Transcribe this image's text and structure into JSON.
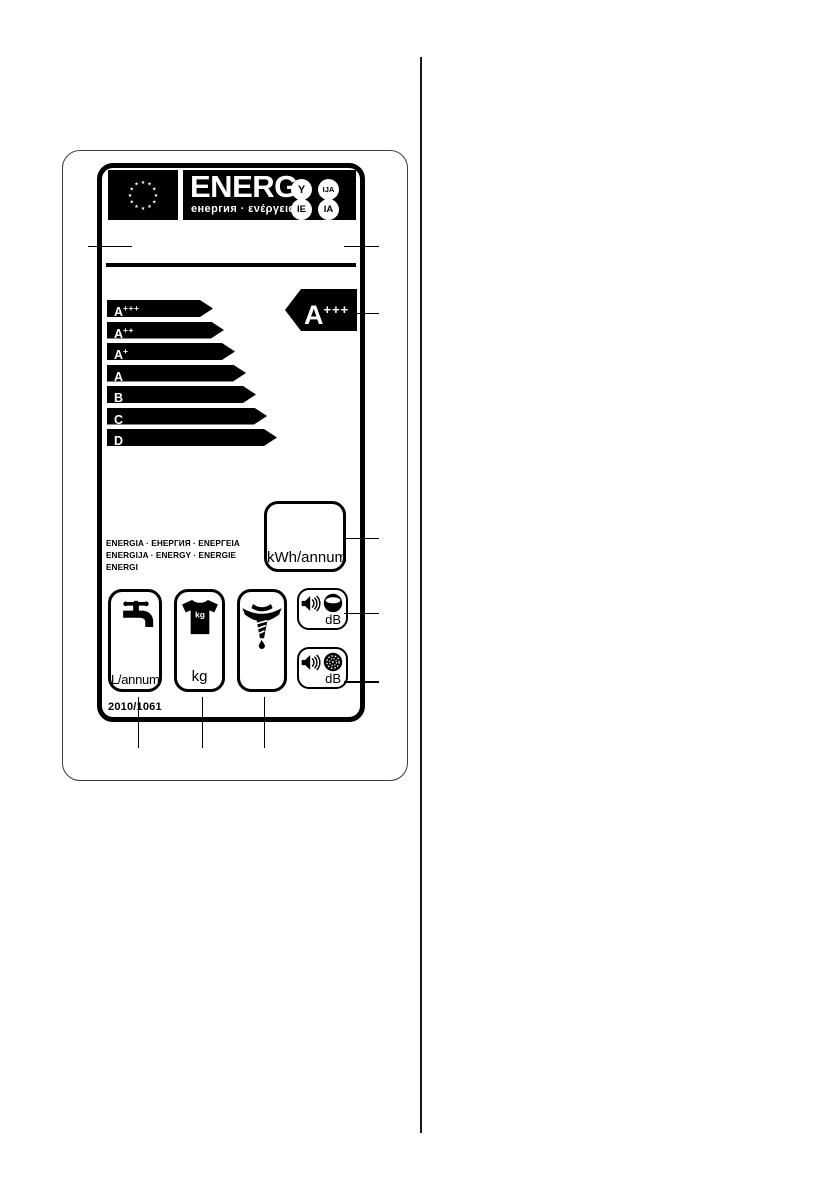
{
  "label": {
    "header": {
      "brand": "ENERG",
      "brand_sub": "енергия · ενέργεια",
      "suffix_y": "Y",
      "suffix_ija": "IJA",
      "suffix_ie": "IE",
      "suffix_ia": "IA"
    },
    "scale": {
      "classes": [
        {
          "base": "A",
          "sup": "+++"
        },
        {
          "base": "A",
          "sup": "++"
        },
        {
          "base": "A",
          "sup": "+"
        },
        {
          "base": "A",
          "sup": ""
        },
        {
          "base": "B",
          "sup": ""
        },
        {
          "base": "C",
          "sup": ""
        },
        {
          "base": "D",
          "sup": ""
        }
      ]
    },
    "rating": {
      "base": "A",
      "sup": "+++"
    },
    "energy": {
      "unit": "kWh/annum"
    },
    "energy_words": {
      "line1": "ENERGIA · ЕНЕРГИЯ · ΕΝΕΡΓΕΙΑ",
      "line2": "ENERGIJA · ENERGY · ENERGIE",
      "line3": "ENERGI"
    },
    "water": {
      "unit": "L/annum"
    },
    "capacity": {
      "icon_label": "kg",
      "unit": "kg"
    },
    "noise_wash": {
      "unit": "dB"
    },
    "noise_spin": {
      "unit": "dB"
    },
    "regulation": "2010/1061"
  },
  "colors": {
    "ink": "#000000",
    "paper": "#ffffff"
  }
}
